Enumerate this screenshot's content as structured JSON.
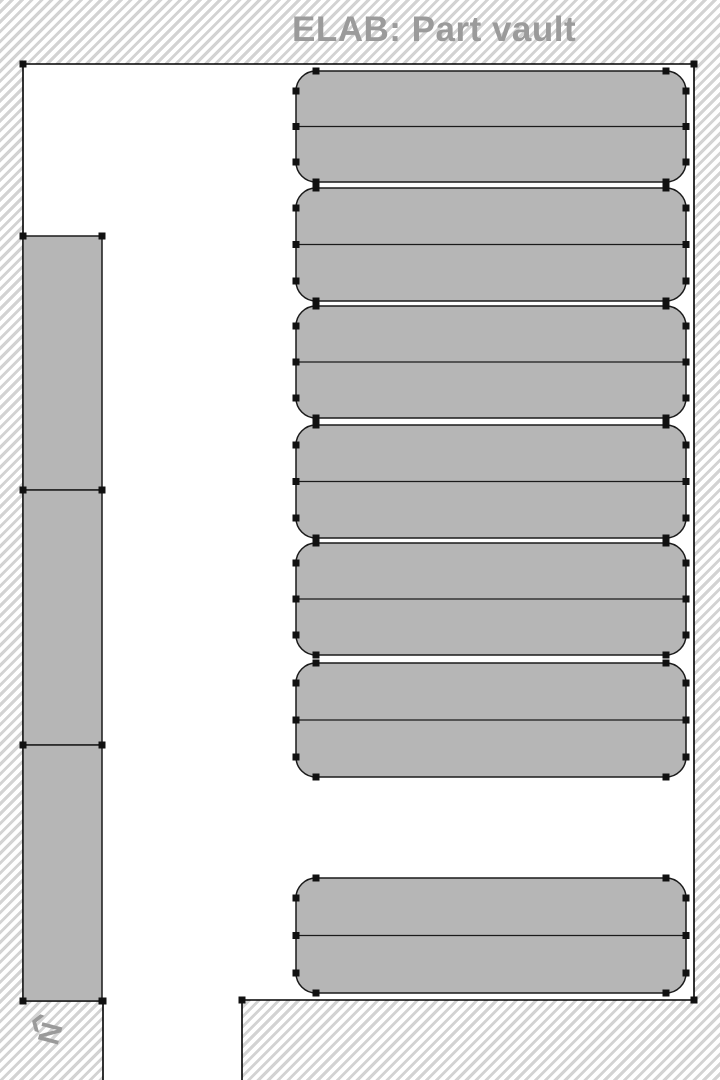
{
  "title": {
    "text": "ELAB: Part vault"
  },
  "compass": {
    "letter": "N",
    "arrow_glyph": "❮"
  },
  "colors": {
    "background": "#ffffff",
    "hatch_stripe": "#d3d3d3",
    "room_fill": "#ffffff",
    "wall": "#000000",
    "unit_fill": "#b6b6b6",
    "unit_border": "#1a1a1a",
    "vertex_marker": "#111111",
    "title_text": "#9b9b9b",
    "compass_text": "#9a9a9a"
  },
  "floor_plan": {
    "canvas": {
      "width": 720,
      "height": 1080
    },
    "room_wall_path": "M103,1080 L103,1001 L23,1001 L23,64 L694,64 L694,1000 L242,1000 L242,1080",
    "room_corner_markers": [
      [
        23,
        64
      ],
      [
        694,
        64
      ],
      [
        694,
        1000
      ],
      [
        242,
        1000
      ],
      [
        23,
        1001
      ],
      [
        103,
        1001
      ]
    ],
    "left_racks": {
      "x": 23,
      "width": 79,
      "items": [
        {
          "y": 236,
          "height": 254
        },
        {
          "y": 490,
          "height": 255
        },
        {
          "y": 745,
          "height": 256
        }
      ]
    },
    "shelves": {
      "x": 296,
      "width": 390,
      "corner_radius": 20,
      "items": [
        {
          "y": 71,
          "height": 111
        },
        {
          "y": 188,
          "height": 113
        },
        {
          "y": 306,
          "height": 112
        },
        {
          "y": 425,
          "height": 113
        },
        {
          "y": 543,
          "height": 112
        },
        {
          "y": 663,
          "height": 114
        },
        {
          "y": 878,
          "height": 115
        }
      ]
    },
    "marker_size": 7
  }
}
